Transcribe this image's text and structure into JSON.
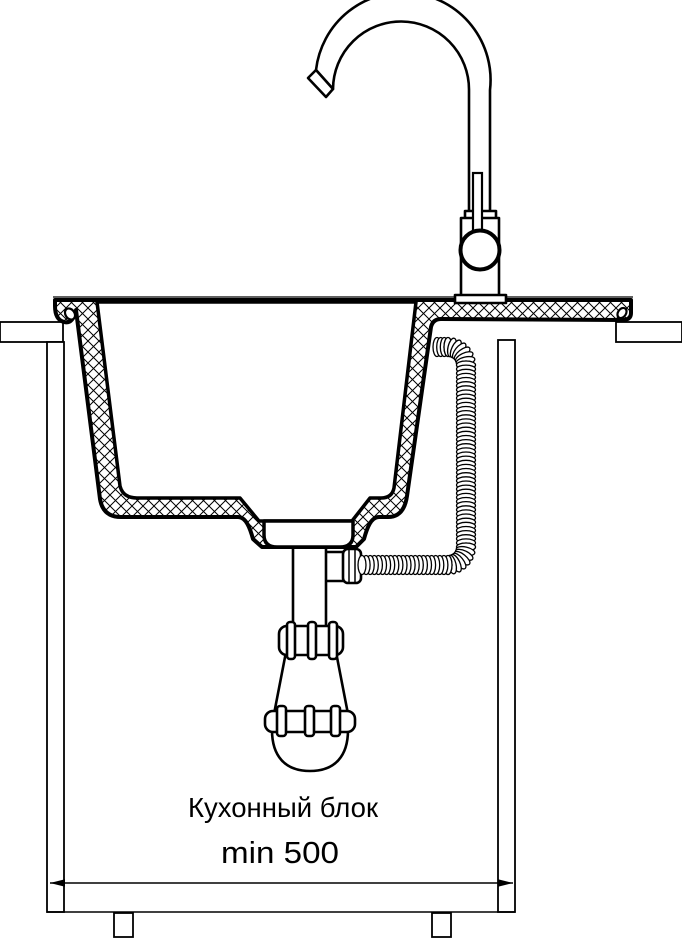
{
  "diagram": {
    "type": "kitchen-sink-installation-cross-section",
    "labels": {
      "cabinet_label": "Кухонный блок",
      "min_width_label": "min 500"
    },
    "colors": {
      "line": "#000000",
      "background": "#ffffff"
    }
  }
}
